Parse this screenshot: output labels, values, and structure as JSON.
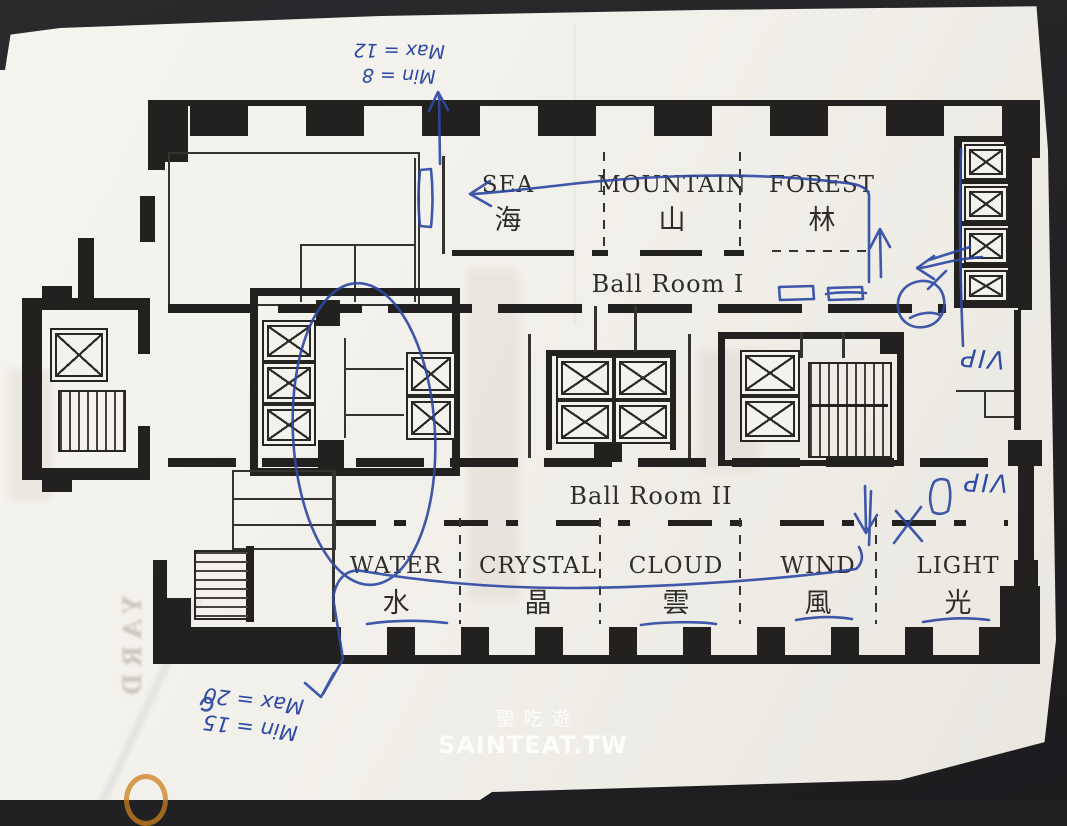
{
  "photo": {
    "backdrop_color": "#212124",
    "paper_color": "#f2f0ea"
  },
  "floor_plan": {
    "ballroom_1": "Ball Room I",
    "ballroom_2": "Ball Room II",
    "rooms_top": [
      {
        "en": "SEA",
        "zh": "海"
      },
      {
        "en": "MOUNTAIN",
        "zh": "山"
      },
      {
        "en": "FOREST",
        "zh": "林"
      }
    ],
    "rooms_bottom": [
      {
        "en": "WATER",
        "zh": "水"
      },
      {
        "en": "CRYSTAL",
        "zh": "晶"
      },
      {
        "en": "CLOUD",
        "zh": "雲"
      },
      {
        "en": "WIND",
        "zh": "風"
      },
      {
        "en": "LIGHT",
        "zh": "光"
      }
    ]
  },
  "annotations": {
    "ink_color": "#2e4aa3",
    "top_note": {
      "line1": "Min = 8",
      "line2": "Max = 12"
    },
    "bottom_note": {
      "line1": "Min = 15",
      "line2": "Max = 20"
    },
    "vip_note_upper": "VIP",
    "vip_note_lower": "VIP"
  },
  "watermark": {
    "line1": "聖吃遊",
    "line2": "SAINTEAT.TW"
  },
  "show_through": {
    "text": "YARD"
  }
}
